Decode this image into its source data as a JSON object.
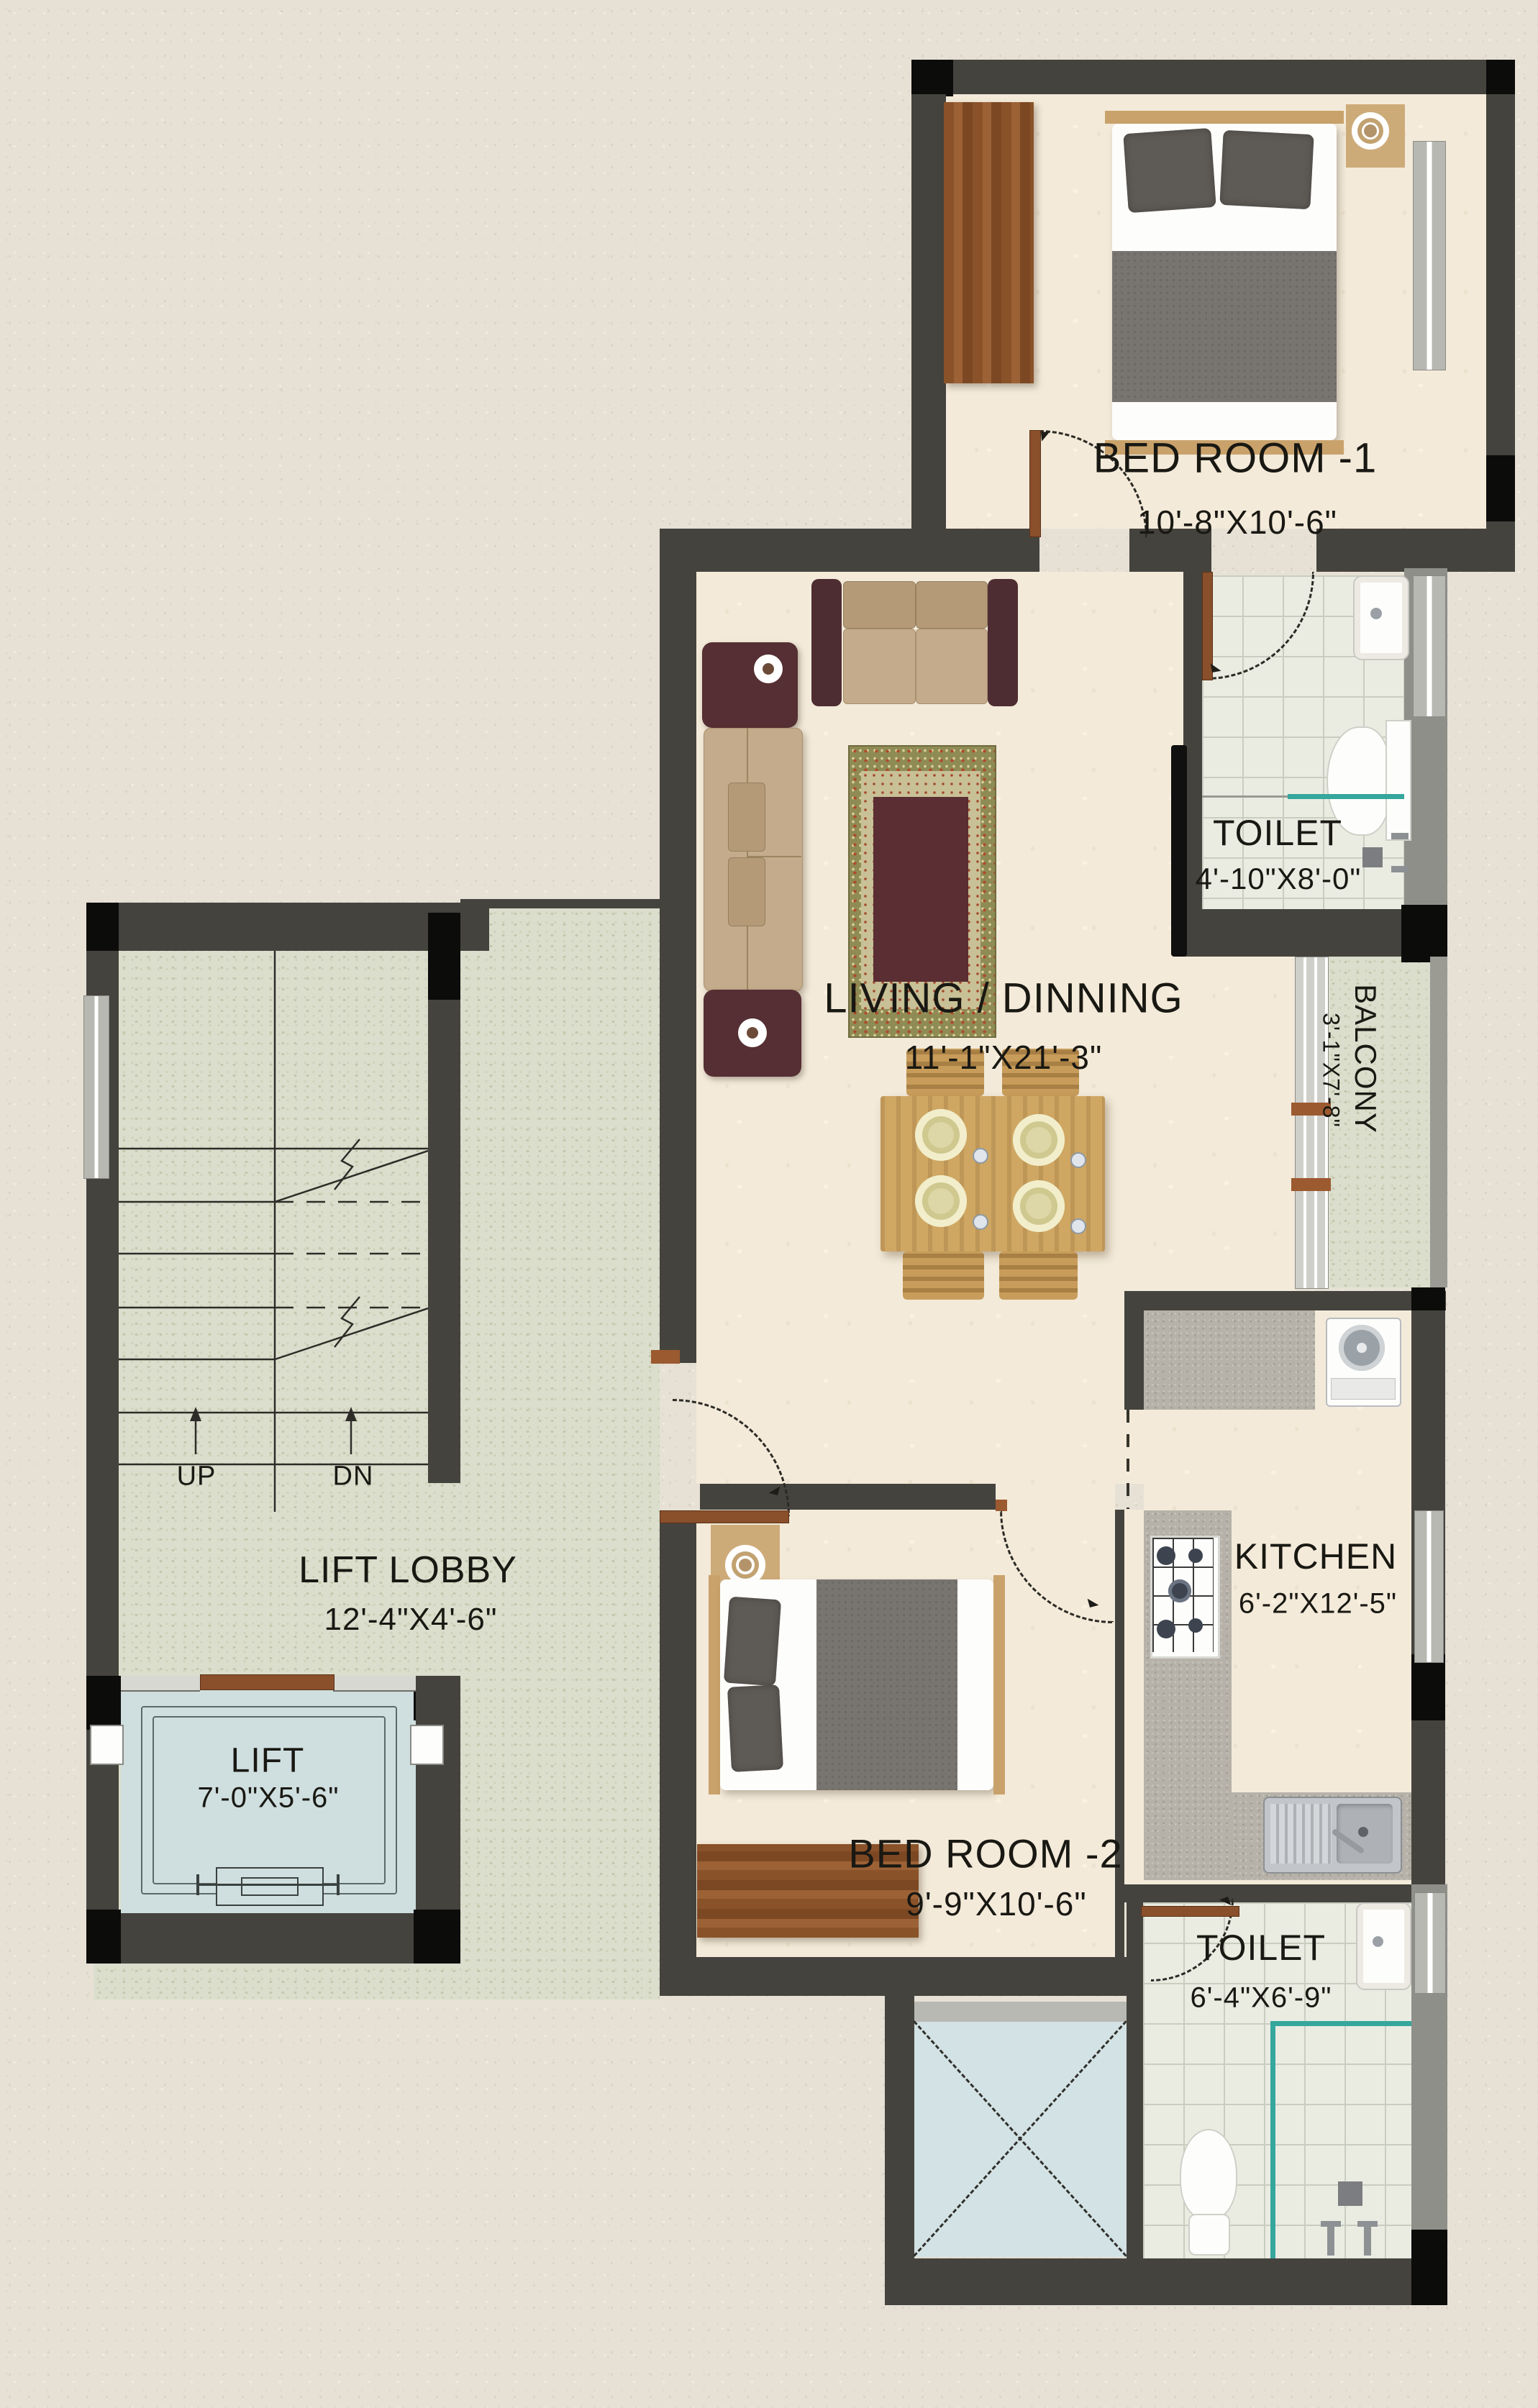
{
  "plan": {
    "rooms": {
      "bedroom1": {
        "name": "BED ROOM -1",
        "dims": "10'-8\"X10'-6\""
      },
      "toilet1": {
        "name": "TOILET",
        "dims": "4'-10\"X8'-0\""
      },
      "balcony": {
        "name": "BALCONY",
        "dims": "3'-1\"X7'-8\""
      },
      "living": {
        "name": "LIVING / DINNING",
        "dims": "11'-1\"X21'-3\""
      },
      "kitchen": {
        "name": "KITCHEN",
        "dims": "6'-2\"X12'-5\""
      },
      "bedroom2": {
        "name": "BED ROOM -2",
        "dims": "9'-9\"X10'-6\""
      },
      "toilet2": {
        "name": "TOILET",
        "dims": "6'-4\"X6'-9\""
      },
      "lift_lobby": {
        "name": "LIFT LOBBY",
        "dims": "12'-4\"X4'-6\""
      },
      "lift": {
        "name": "LIFT",
        "dims": "7'-0\"X5'-6\""
      }
    },
    "stairs": {
      "up": "UP",
      "down": "DN"
    },
    "colors": {
      "wall": "#45433e",
      "column": "#0c0c0b",
      "floor_cream": "#f3ead9",
      "floor_tile": "#eaece2",
      "floor_speckle": "#dbdecc",
      "lift_floor": "#cfdede",
      "duct_floor": "#d3e2e4",
      "accent_teal": "#35a79c",
      "wood": "#8a5229",
      "text": "#191813"
    }
  }
}
